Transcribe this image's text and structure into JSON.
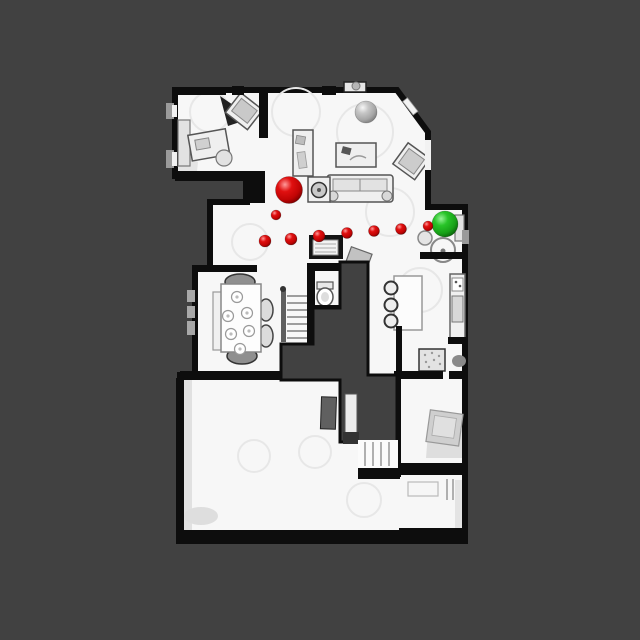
{
  "canvas": {
    "width": 640,
    "height": 640,
    "background_color": "#414141"
  },
  "floorplan": {
    "floor_color": "#f7f7f7",
    "wall_color": "#0d0d0d"
  },
  "markers": {
    "path_color": "#e01010",
    "goal_color": "#28c428",
    "neutral_color": "#c6c6c6",
    "start": {
      "x": 289,
      "y": 190,
      "r": 13.5
    },
    "goal": {
      "x": 445,
      "y": 224,
      "r": 13
    },
    "neutral": {
      "x": 366,
      "y": 112,
      "r": 11
    },
    "waypoints": [
      {
        "x": 276,
        "y": 215,
        "r": 5
      },
      {
        "x": 265,
        "y": 241,
        "r": 6
      },
      {
        "x": 291,
        "y": 239,
        "r": 6
      },
      {
        "x": 319,
        "y": 236,
        "r": 6
      },
      {
        "x": 347,
        "y": 233,
        "r": 5.5
      },
      {
        "x": 374,
        "y": 231,
        "r": 5.5
      },
      {
        "x": 401,
        "y": 229,
        "r": 5.5
      },
      {
        "x": 428,
        "y": 226,
        "r": 5
      }
    ]
  }
}
